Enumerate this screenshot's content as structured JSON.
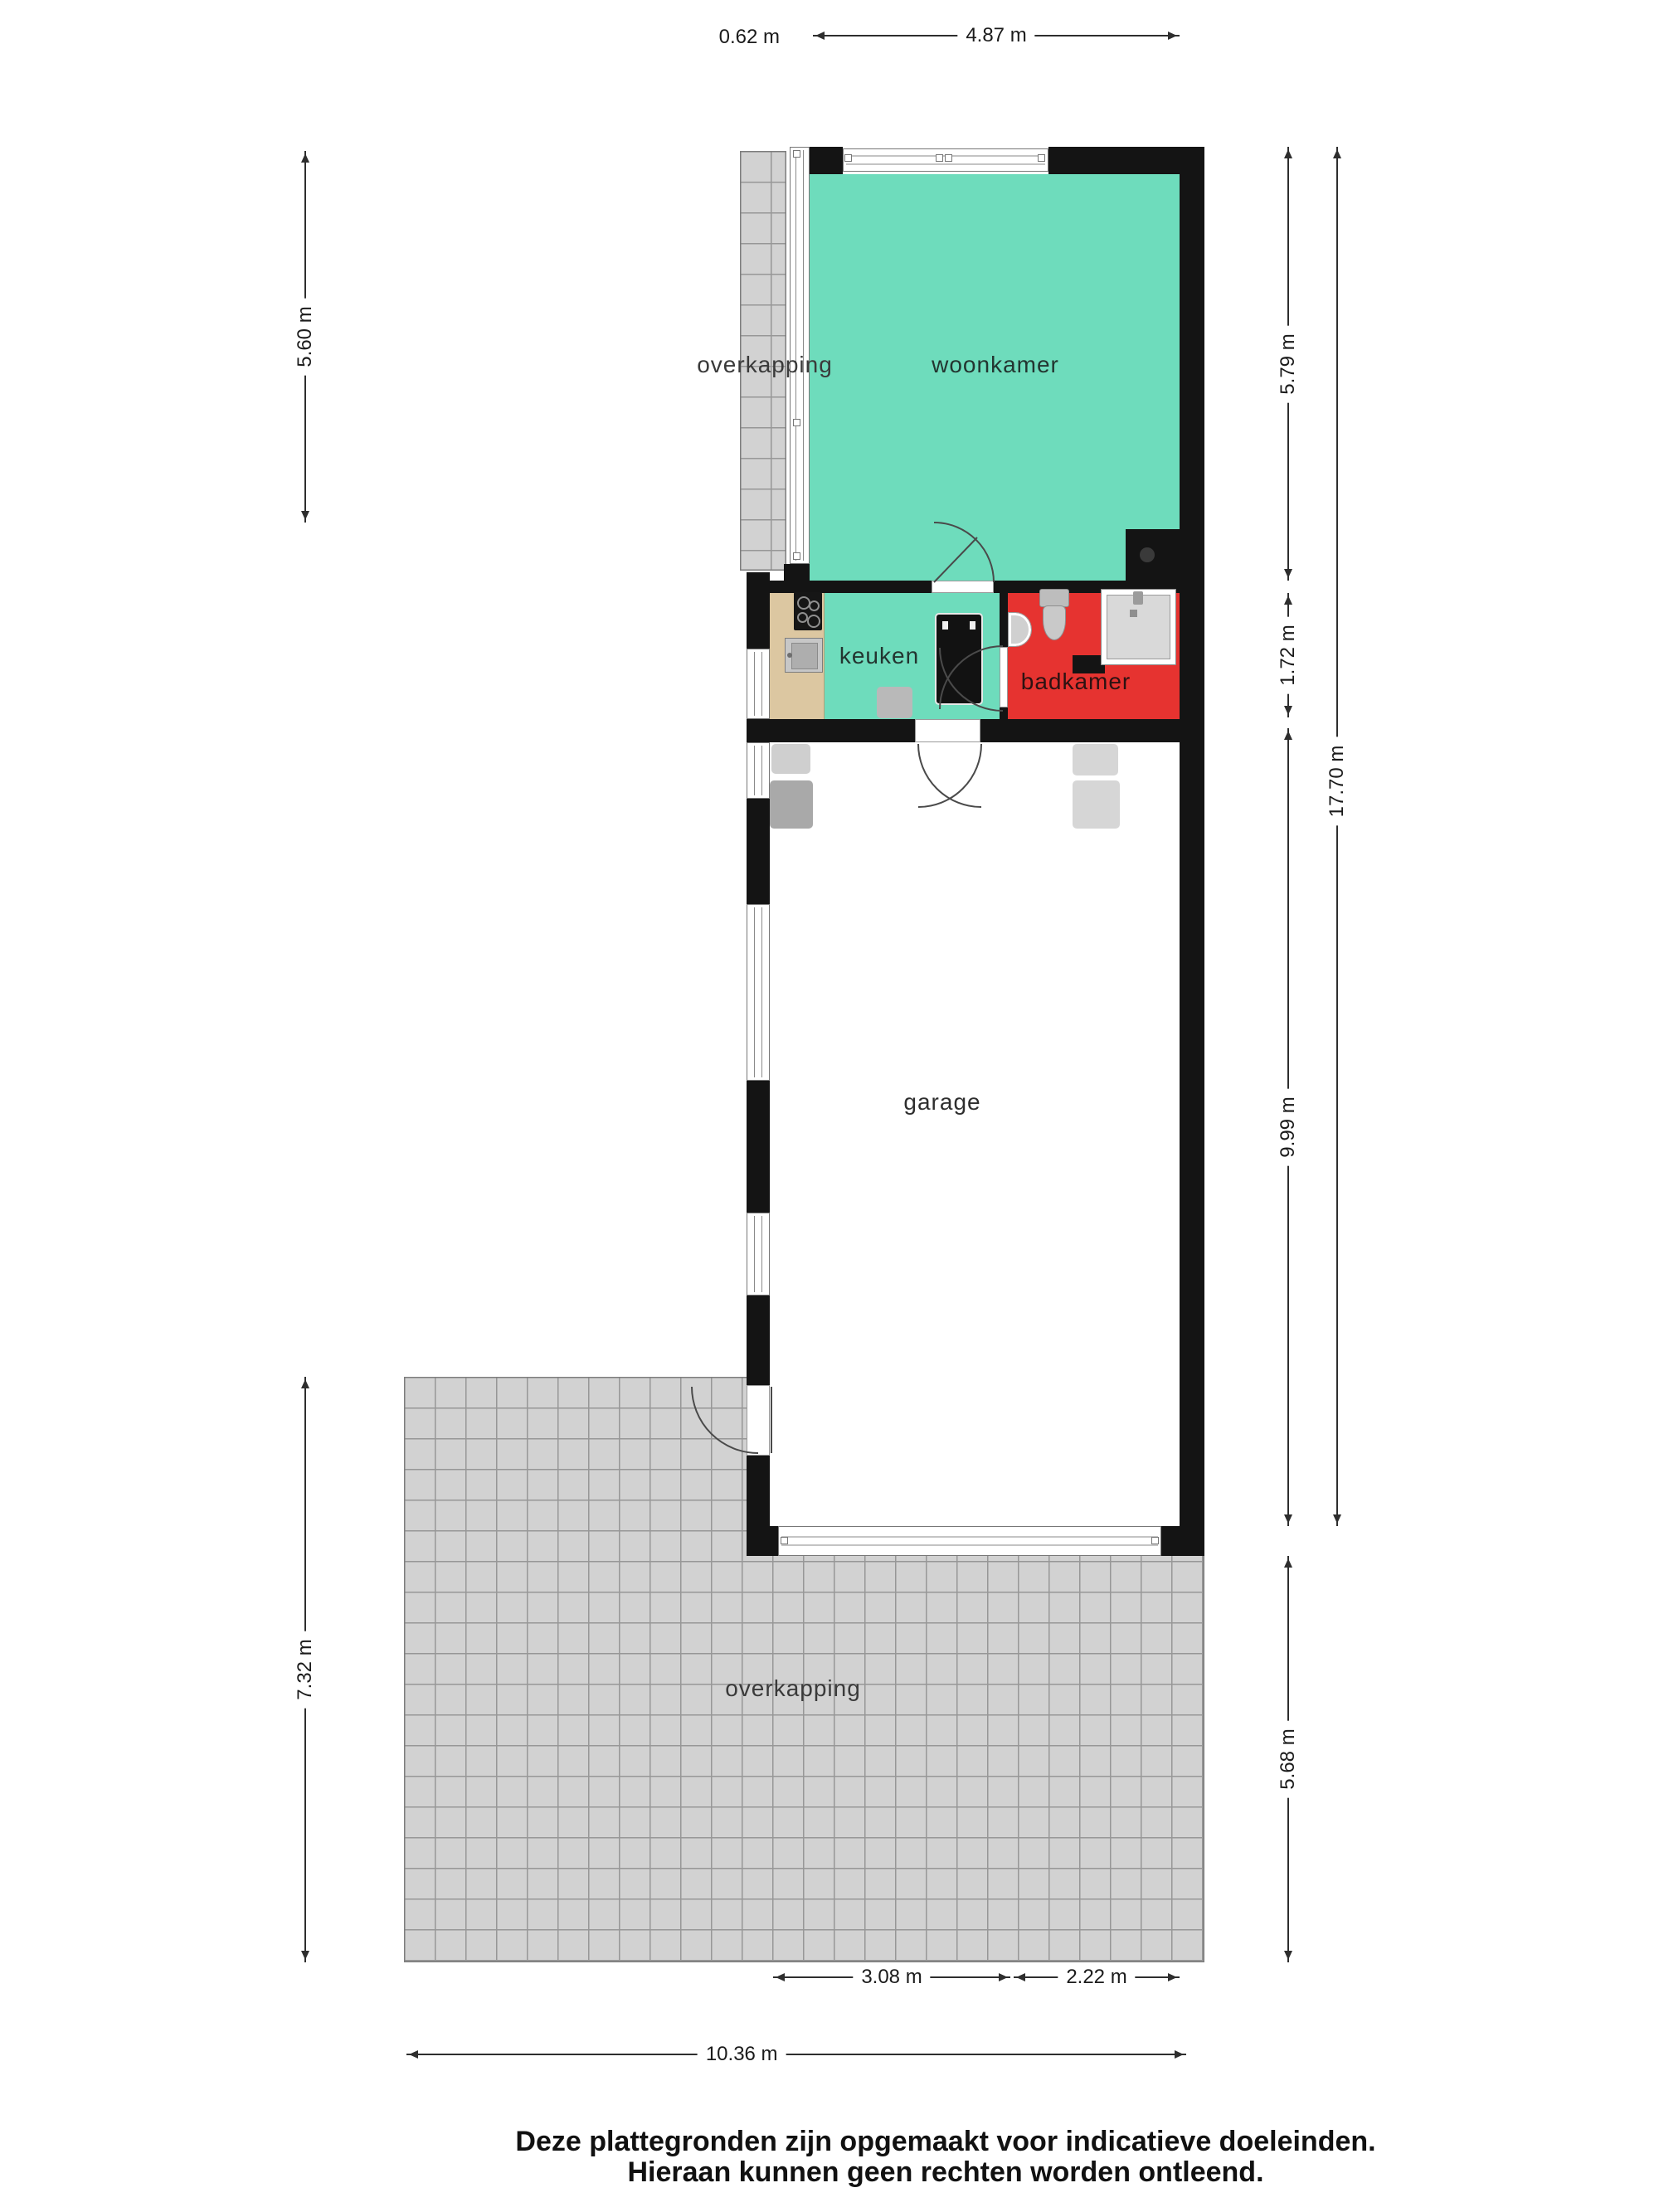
{
  "rooms": {
    "overkapping_top": {
      "label": "overkapping"
    },
    "woonkamer": {
      "label": "woonkamer"
    },
    "keuken": {
      "label": "keuken"
    },
    "badkamer": {
      "label": "badkamer"
    },
    "garage": {
      "label": "garage"
    },
    "overkapping_bottom": {
      "label": "overkapping"
    }
  },
  "dimensions": {
    "top_offset": "0.62 m",
    "top_width": "4.87 m",
    "left_overkapping_top": "5.60 m",
    "left_overkapping_bottom": "7.32 m",
    "right_woonkamer": "5.79 m",
    "right_keuken_badkamer": "1.72 m",
    "right_total": "17.70 m",
    "right_garage": "9.99 m",
    "right_overkapping": "5.68 m",
    "bottom_garage_door": "3.08 m",
    "bottom_right_segment": "2.22 m",
    "bottom_total": "10.36 m"
  },
  "footer": {
    "line1": "Deze plattegronden zijn opgemaakt voor indicatieve doeleinden.",
    "line2": "Hieraan kunnen geen rechten worden ontleend."
  },
  "colors": {
    "room_teal": "#6edcbc",
    "room_red": "#e63330",
    "counter_tan": "#dcc7a1",
    "tile_gray": "#d2d2d2",
    "wall_black": "#141414"
  }
}
